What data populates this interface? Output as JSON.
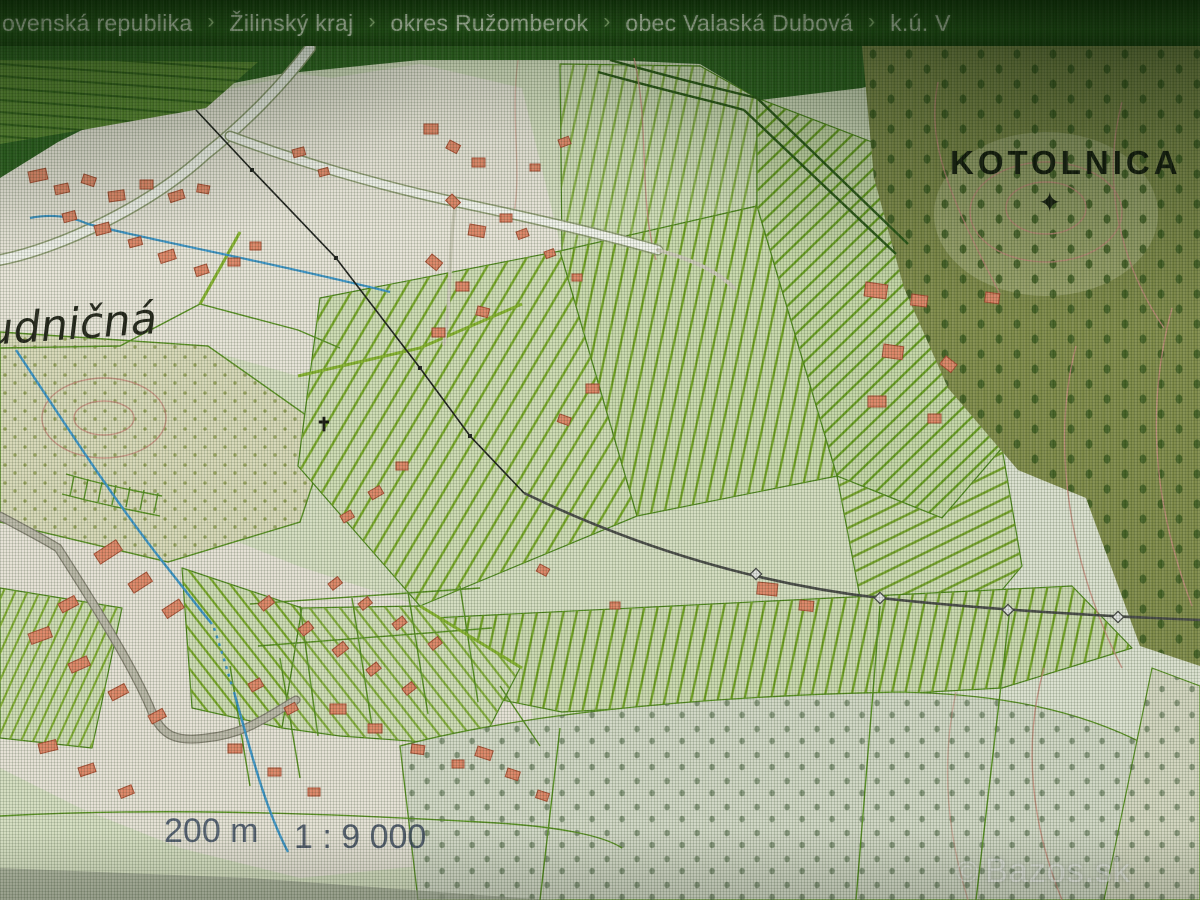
{
  "breadcrumb": {
    "separator": "›",
    "items": [
      {
        "label": "ovenská republika"
      },
      {
        "label": "Žilinský kraj"
      },
      {
        "label": "okres Ružomberok"
      },
      {
        "label": "obec Valaská Dubová"
      },
      {
        "label": "k.ú. V"
      }
    ]
  },
  "map": {
    "hill_label": "KOTOLNICA",
    "summit_icon": "✦",
    "area_label": "udničná",
    "cross_icon": "✝",
    "scale_bar_label": "200 m",
    "scale_ratio": "1 : 9 000",
    "watermark_icon": "©",
    "watermark_text": "Bazos.sk"
  },
  "colors": {
    "breadcrumb_bg": "#1d4c13",
    "breadcrumb_text": "#d9e7d0",
    "parcel_line": "#5a9422",
    "field_stripe": "#7cae27",
    "building_fill": "#e8896c",
    "building_stroke": "#b04f36",
    "contour": "#cf9184",
    "stream": "#3f9ad2",
    "forest_dark": "#2e6421",
    "scale_text": "#44506a"
  }
}
